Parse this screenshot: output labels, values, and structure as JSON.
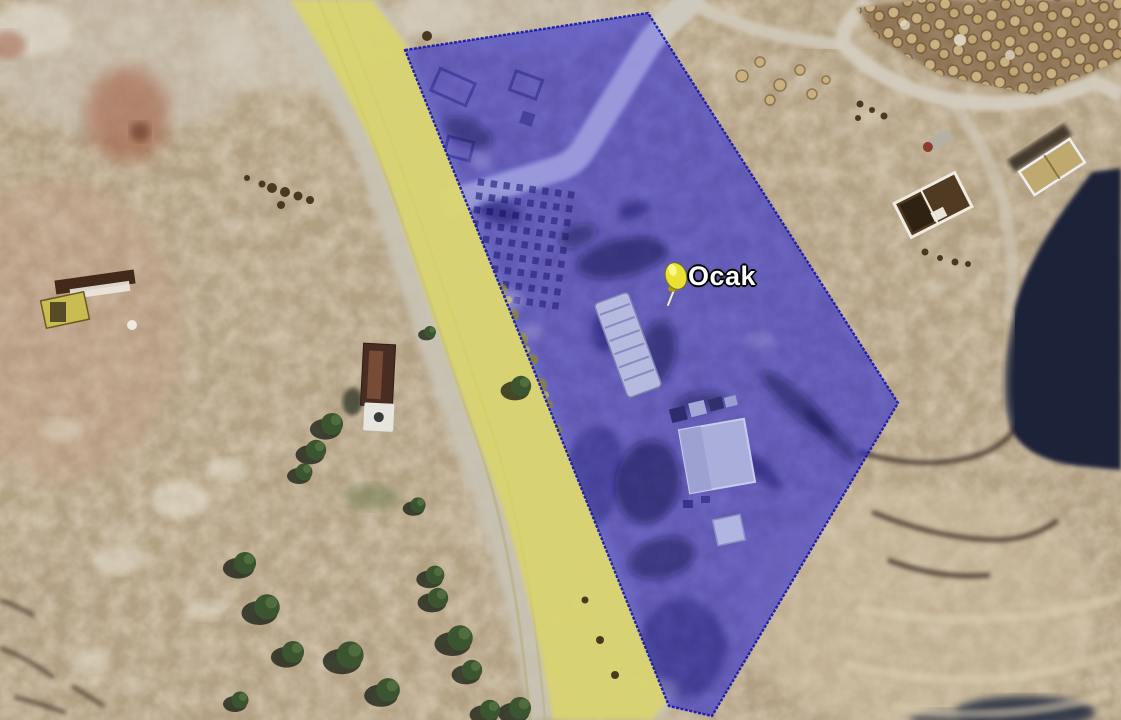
{
  "scene": {
    "kind": "satellite-map-view"
  },
  "placemark": {
    "label": "Ocak",
    "pin_color": "#e8e232",
    "pin_color_dark": "#a79b10",
    "label_color": "#ffffff",
    "label_outline_color": "#000000"
  },
  "overlays": {
    "site_polygon": {
      "fill": "rgba(30,30,215,0.55)",
      "stroke": "#1a1aae"
    },
    "road_overlay": {
      "fill": "rgba(222,216,90,0.72)"
    }
  },
  "terrain": {
    "ground_color": "#b3a184",
    "shadow_color": "#1b2137",
    "tree_color": "#3a5530"
  }
}
